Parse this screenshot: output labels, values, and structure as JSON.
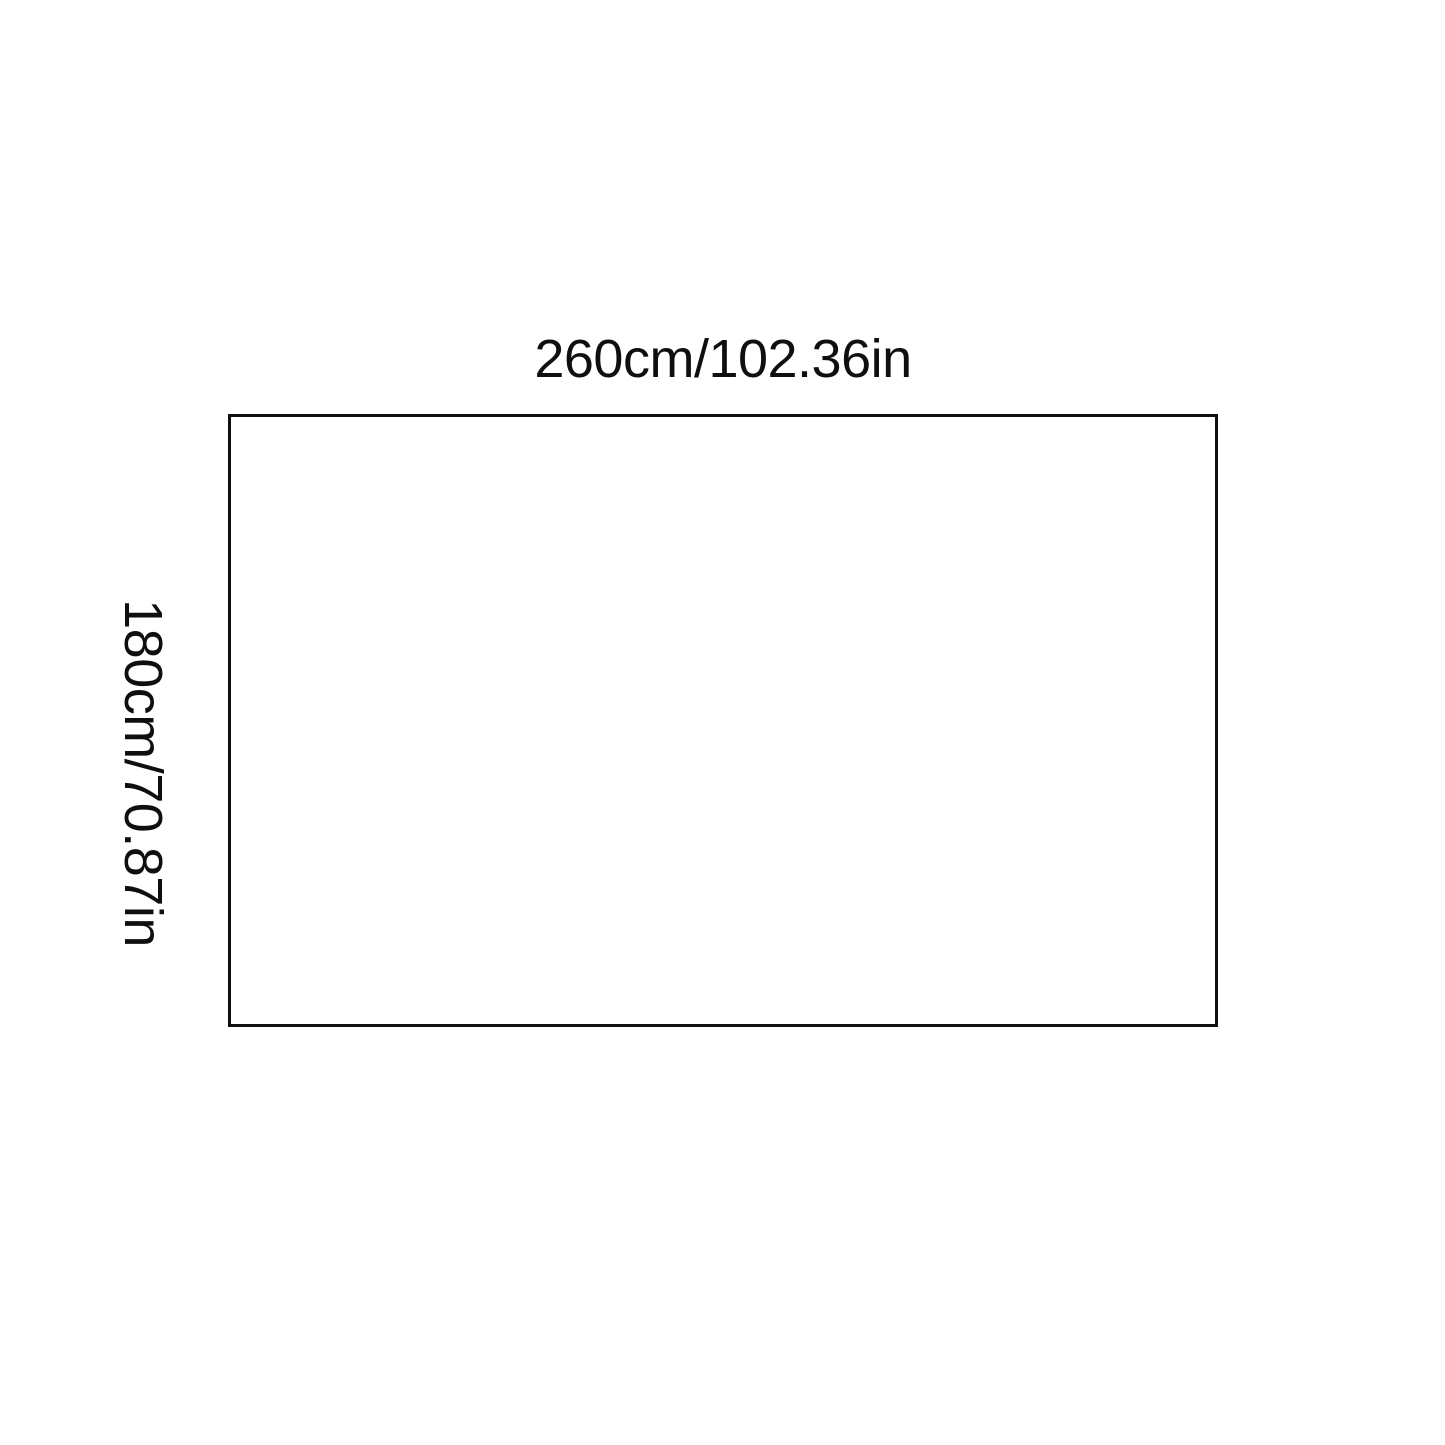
{
  "page": {
    "background_color": "#ffffff"
  },
  "diagram": {
    "kind": "product-dimension-diagram",
    "rectangle": {
      "border_color": "#0f0f0f",
      "fill_color": "#ffffff"
    },
    "labels": {
      "width_label": "260cm/102.36in",
      "height_label": "180cm/70.87in",
      "text_color": "#0f0f0f"
    }
  }
}
